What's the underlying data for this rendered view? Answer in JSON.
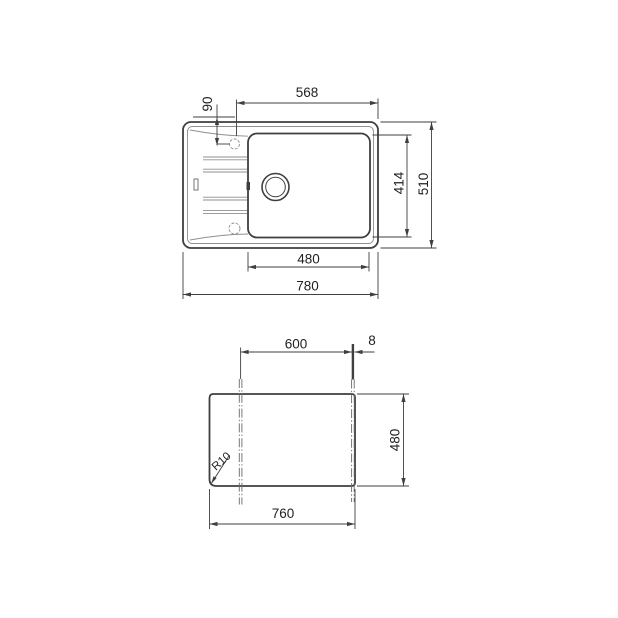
{
  "drawing": {
    "background": "#ffffff",
    "line_color": "#3f3f3f",
    "top_view": {
      "overall_width": "780",
      "overall_depth": "510",
      "bowl_width": "480",
      "bowl_depth": "414",
      "tap_hole_to_right_edge": "568",
      "tap_hole_offset": "90"
    },
    "cutout_view": {
      "cutout_width": "760",
      "cutout_depth": "480",
      "fixing_centres": "600",
      "edge_offset": "8",
      "corner_radius_label": "R10"
    }
  }
}
